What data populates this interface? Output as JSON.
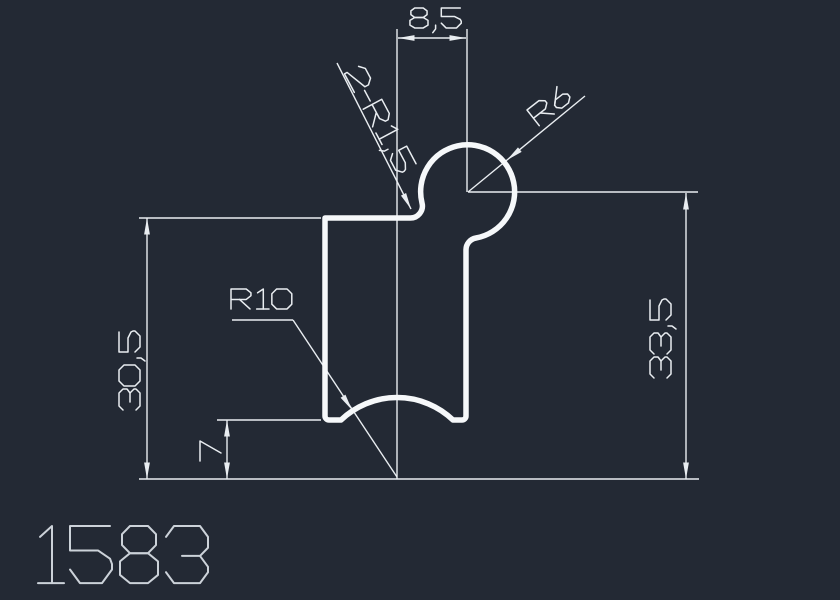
{
  "app": {
    "type": "cad-drawing-view",
    "background_color": "#232934",
    "line_color": "#e9edf1",
    "profile_color": "#f6f8fa",
    "number_color": "#ccd2d9"
  },
  "drawing": {
    "number": "1583",
    "dimensions": [
      {
        "id": "dim-8-5",
        "label": "8,5",
        "kind": "linear-horizontal",
        "value": 8.5
      },
      {
        "id": "dim-30-5",
        "label": "30,5",
        "kind": "linear-vertical",
        "value": 30.5
      },
      {
        "id": "dim-7",
        "label": "7",
        "kind": "linear-vertical",
        "value": 7
      },
      {
        "id": "dim-33-5",
        "label": "33,5",
        "kind": "linear-vertical",
        "value": 33.5
      },
      {
        "id": "dim-2r15",
        "label": "2-R1,5",
        "kind": "radius-leader",
        "value": 1.5,
        "count": 2
      },
      {
        "id": "dim-r6",
        "label": "R6",
        "kind": "radius-leader",
        "value": 6
      },
      {
        "id": "dim-r10",
        "label": "R10",
        "kind": "radius-leader",
        "value": 10
      }
    ]
  }
}
